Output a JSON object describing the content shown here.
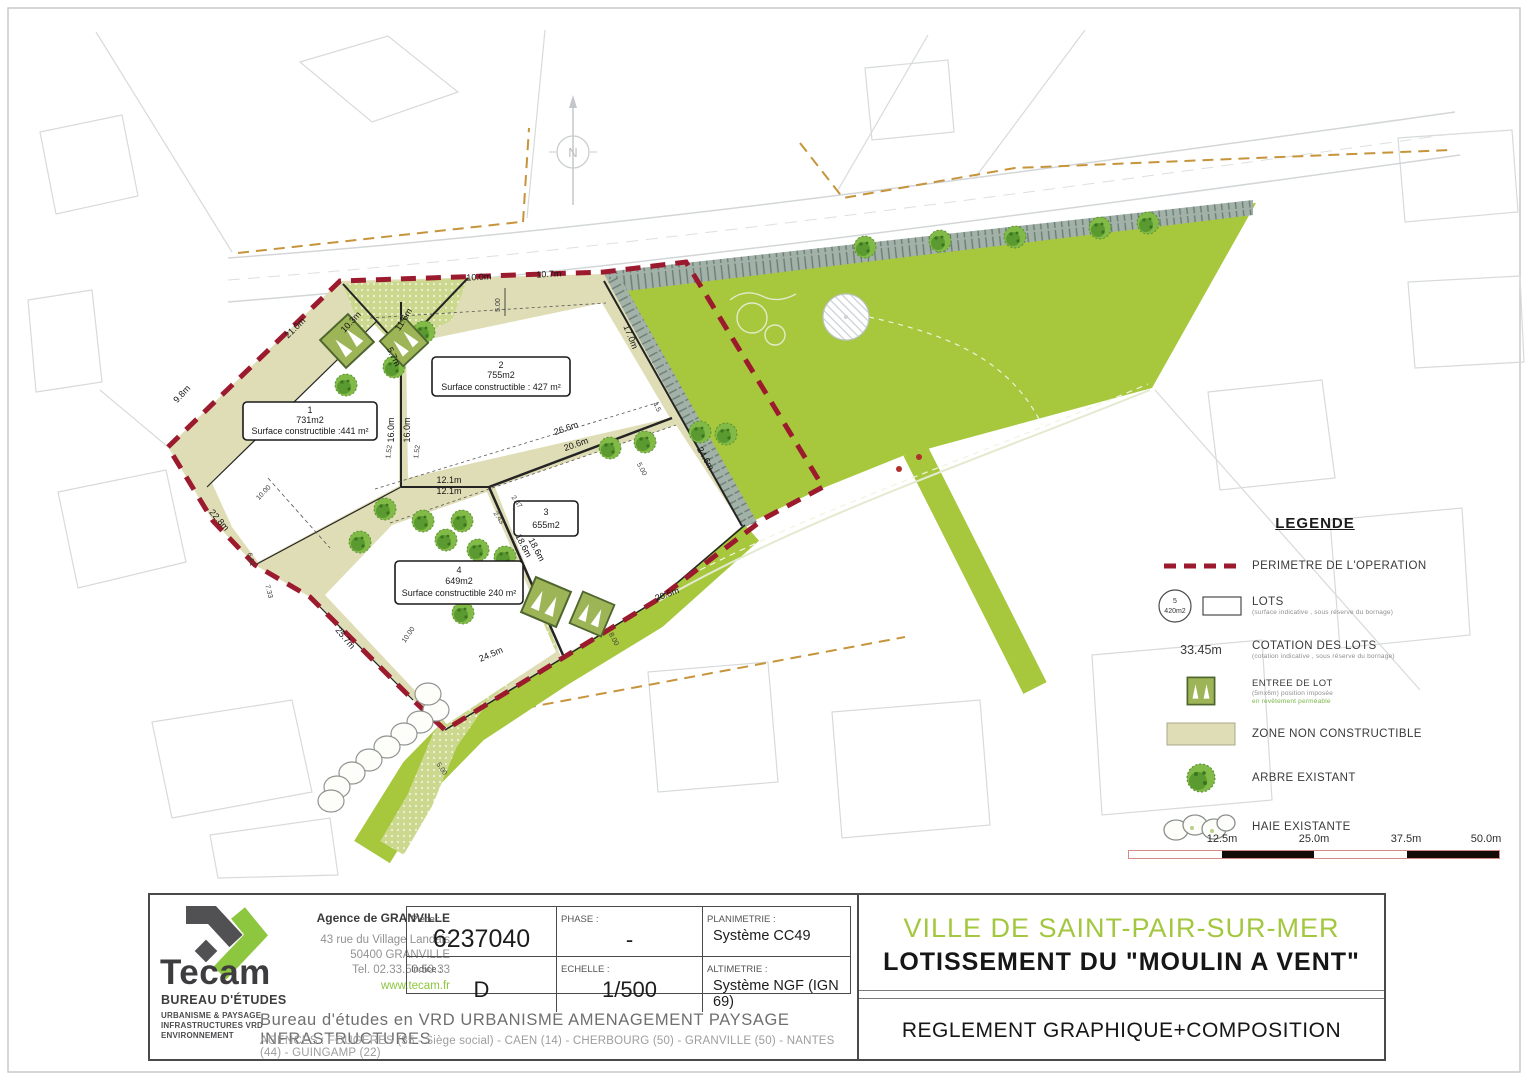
{
  "plan": {
    "north": "N",
    "lots": [
      {
        "num": "1",
        "area": "731m2",
        "surface": "Surface constructible :441 m²"
      },
      {
        "num": "2",
        "area": "755m2",
        "surface": "Surface constructible : 427 m²"
      },
      {
        "num": "3",
        "area": "655m2"
      },
      {
        "num": "4",
        "area": "649m2",
        "surface": "Surface constructible 240 m²"
      }
    ],
    "dims": {
      "d21": "21.0m",
      "d98": "9.8m",
      "d228": "22.8m",
      "d257": "25.7m",
      "d100": "10.0m",
      "d107": "10.7m",
      "d103": "10.3m",
      "d116": "11.6m",
      "d57": "5.7m",
      "d170": "17.0m",
      "d160a": "16.0m",
      "d160b": "16.0m",
      "d121a": "12.1m",
      "d121b": "12.1m",
      "d266a": "26.6m",
      "d266b": "20.6m",
      "d186a": "18.6m",
      "d186b": "18.6m",
      "d245": "24.5m",
      "d205": "20.5m",
      "d246": "24.6m",
      "s500a": "5.00",
      "s500b": "5.00",
      "s500c": "5.00",
      "s1000a": "10.00",
      "s1000b": "10.00",
      "s661": "6.61",
      "s733": "7.33",
      "s152a": "1.52",
      "s152b": "1.52",
      "s243": "2.43",
      "s247": "2.47",
      "s800": "8.00",
      "s45": "4.5"
    }
  },
  "legend": {
    "title": "LEGENDE",
    "perimetre": "PERIMETRE DE L'OPERATION",
    "lot_badge_num": "5",
    "lot_badge_area": "420m2",
    "lots": "LOTS",
    "lots_sub": "(surface indicative , sous réserve du bornage)",
    "cotation_value": "33.45m",
    "cotation": "COTATION DES LOTS",
    "cotation_sub": "(cotation indicative , sous réserve du bornage)",
    "entree": "ENTREE DE LOT",
    "entree_sub1": "(5mx6m) position imposée",
    "entree_sub2": "en revêtement perméable",
    "zone": "ZONE NON CONSTRUCTIBLE",
    "arbre": "ARBRE EXISTANT",
    "haie": "HAIE EXISTANTE"
  },
  "scalebar": {
    "labels": [
      "12.5m",
      "25.0m",
      "37.5m",
      "50.0m"
    ]
  },
  "titleblock": {
    "logo_name": "Tecam",
    "logo_sub": "BUREAU D'ÉTUDES",
    "logo_line1": "URBANISME & PAYSAGE",
    "logo_line2": "INFRASTRUCTURES VRD",
    "logo_line3": "ENVIRONNEMENT",
    "agence_title": "Agence de GRANVILLE",
    "agence_line1": "43 rue du Village Landais",
    "agence_line2": "50400 GRANVILLE",
    "agence_line3": "Tel. 02.33.50.50.33",
    "agence_web": "www.tecam.fr",
    "piece_label": "Pièce :",
    "piece": "6237040",
    "phase_label": "PHASE :",
    "phase": "-",
    "plani_label": "PLANIMETRIE :",
    "plani": "Système CC49",
    "indice_label": "Indice :",
    "indice": "D",
    "echelle_label": "ECHELLE :",
    "echelle": "1/500",
    "alti_label": "ALTIMETRIE :",
    "alti": "Système NGF (IGN 69)",
    "footer_main": "Bureau d'études en VRD  URBANISME  AMENAGEMENT  PAYSAGE  INFRASTRUCTURES",
    "footer_agences": "AGENCES :  FOUGERES (35 - Siège social) - CAEN (14) - CHERBOURG (50) - GRANVILLE (50) - NANTES (44) - GUINGAMP (22)",
    "ville": "VILLE DE SAINT-PAIR-SUR-MER",
    "projet": "LOTISSEMENT DU \"MOULIN A VENT\"",
    "doc": "REGLEMENT GRAPHIQUE+COMPOSITION"
  },
  "colors": {
    "grass_green": "#a7c73d",
    "beige_zone": "#dfddb6",
    "perimeter_red": "#9c1a2e",
    "tecam_green": "#8dc63f",
    "boundary_tan": "#c6943b"
  }
}
